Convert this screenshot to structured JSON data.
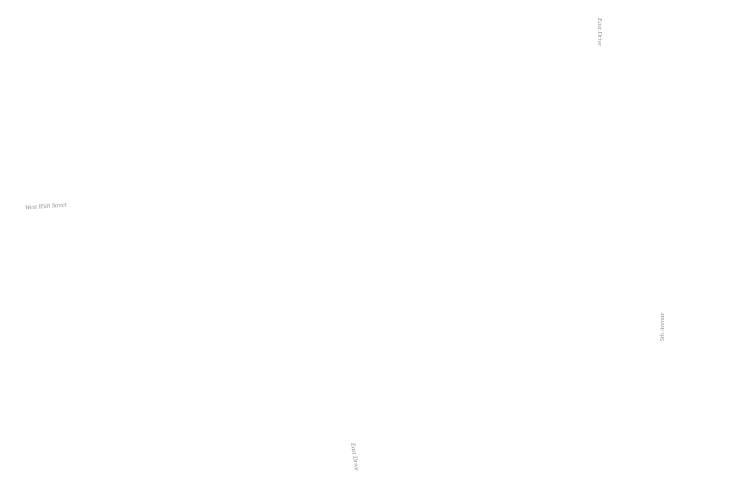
{
  "title": "Park site plan",
  "labels": {
    "west_street": "West 85th Street",
    "east_drive_top": "East Drive",
    "east_drive_bottom": "East Drive",
    "fifth_avenue": "5th Avenue"
  },
  "colors": {
    "background": "#ffffff",
    "shape_stroke": "#8f8f8f",
    "lawn_base": "#e9e9e9",
    "lawn_dot": "#d0d0d0",
    "fill_base": "#ededed",
    "fill_dot": "#c7c7c7",
    "road_line": "#c4c4c4",
    "road_dash": "#bdbdbd",
    "label_text": "#8f8f8f",
    "building": "#e5e5e5",
    "building_faint": "#f1f1f1",
    "square_stroke": "#959595"
  },
  "geometry": {
    "lawn_path": "M0,0 L557,0 L555,48 Q551,68 533,72 L503,79 L481,86 L456,97 L431,112 L402,130 L376,142 L341,152 L301,161 L261,160 L231,152 L186,150 L176,148 L161,150 L141,158 L0,158 Z",
    "lawn_bottom_edge": [
      [
        0,
        158
      ],
      [
        140,
        158
      ],
      [
        161,
        150
      ],
      [
        176,
        148
      ],
      [
        186,
        150
      ],
      [
        231,
        152
      ],
      [
        261,
        160
      ],
      [
        301,
        161
      ],
      [
        341,
        152
      ],
      [
        376,
        142
      ],
      [
        402,
        130
      ],
      [
        431,
        112
      ],
      [
        456,
        97
      ],
      [
        481,
        86
      ],
      [
        503,
        79
      ],
      [
        533,
        72
      ],
      [
        557,
        60
      ]
    ],
    "ring": {
      "cx": 103,
      "cy": 92,
      "r_outer": 61,
      "r_inner": 52
    },
    "stipple_circles": [
      {
        "cx": 529,
        "cy": 87,
        "r": 17.5
      },
      {
        "cx": 104,
        "cy": 303,
        "r": 31
      },
      {
        "cx": 212,
        "cy": 413,
        "r": 79
      },
      {
        "cx": 424,
        "cy": 411,
        "r": 33
      }
    ],
    "half_circles": [
      {
        "d": "M649,179 A28,28 0 0 0 649,235 Z"
      },
      {
        "d": "M638,380 A33,33 0 0 0 638,446 Z"
      }
    ],
    "void_squares": [
      {
        "x": 177,
        "y": 167,
        "w": 68,
        "h": 68,
        "rx": 10
      },
      {
        "x": 489,
        "y": 261,
        "w": 90,
        "h": 92,
        "rx": 12
      },
      {
        "x": 300,
        "y": 288,
        "w": 38,
        "h": 36,
        "rx": 8
      }
    ],
    "roads": {
      "west_street_lines": [
        "M0,195 C30,204 70,203 118,190 L148,181",
        "M0,211 C30,220 75,218 122,204 L152,195"
      ],
      "drive_solid_top": [
        "M590,0 L590,55",
        "M602,0 L602,55"
      ],
      "drive_dashed": [
        "M590,55 L590,338",
        "M602,55 L602,338"
      ],
      "drive_curve_bottom": [
        "M590,338 C587,415 535,465 341,499",
        "M602,338 C599,428 545,478 360,505"
      ],
      "avenue_line": "M648,0 L648,500"
    },
    "buildings": [
      "M692,2 Q688,2 688,14 L688,50 Q688,70 708,70 L728,70 L728,52 L750,52 L750,24 L736,24 L736,2 Z",
      "M687,96 L722,96 L722,108 L750,108 L750,138 L737,138 L737,160 L701,160 L701,147 L687,147 Z",
      "M687,184 L750,184 L750,214 L736,214 L736,232 L712,232 L712,246 L687,246 Z",
      "M688,269 L750,269 L750,291 L733,291 L733,312 L750,312 L750,331 L706,331 L706,318 L688,318 Z",
      "M687,353 L717,353 L717,366 L750,366 L750,397 L738,397 L738,415 L750,415 L750,431 L711,431 L711,416 L687,416 Z",
      "M687,452 L750,452 L750,500 L711,500 L711,488 L687,488 Z",
      "M588,461 L616,461 L616,456 L637,456 L637,500 L588,500 Z"
    ],
    "building_faint": "M453,472 L530,472 L530,500 L453,500 Z",
    "scatter": [
      {
        "t": "d",
        "x": 97,
        "y": 283,
        "s": 3.0,
        "f": "stip"
      },
      {
        "t": "c",
        "x": 118,
        "y": 291,
        "s": 2.5,
        "f": "none"
      },
      {
        "t": "d",
        "x": 96,
        "y": 331,
        "s": 2.6,
        "f": "none"
      },
      {
        "t": "d",
        "x": 109,
        "y": 352,
        "s": 2.2,
        "f": "stip"
      },
      {
        "t": "c",
        "x": 125,
        "y": 344,
        "s": 2.0,
        "f": "none"
      },
      {
        "t": "d",
        "x": 101,
        "y": 380,
        "s": 1.8,
        "f": "none"
      },
      {
        "t": "c",
        "x": 136,
        "y": 384,
        "s": 2.4,
        "f": "none"
      },
      {
        "t": "c",
        "x": 160,
        "y": 368,
        "s": 2.0,
        "f": "none"
      },
      {
        "t": "d",
        "x": 176,
        "y": 380,
        "s": 3.0,
        "f": "none"
      },
      {
        "t": "c",
        "x": 173,
        "y": 394,
        "s": 4.0,
        "f": "none"
      },
      {
        "t": "c",
        "x": 186,
        "y": 370,
        "s": 2.0,
        "f": "none"
      },
      {
        "t": "d",
        "x": 152,
        "y": 356,
        "s": 3.0,
        "f": "none"
      }
    ],
    "squiggles": [
      "M108,125 q6,8 -2,14 q-8,6 0,14",
      "M112,245 q-6,8 2,16",
      "M553,108 q8,6 2,14",
      "M246,92 q6,-8 14,-2",
      "M118,348 q-8,6 -2,14 q6,8 -2,12"
    ],
    "pattern": {
      "x0": 118,
      "y0": 88,
      "dx": 13.2,
      "dy": 13.2,
      "cols": 41,
      "rows": 25,
      "x_max": 648,
      "road_gap": [
        584,
        608
      ],
      "road_gap_ymax": 338,
      "exclusions": [
        {
          "cx": 103,
          "cy": 92,
          "r": 71
        },
        {
          "cx": 529,
          "cy": 87,
          "r": 27
        },
        {
          "cx": 104,
          "cy": 303,
          "r": 39
        },
        {
          "cx": 212,
          "cy": 413,
          "r": 87
        },
        {
          "cx": 424,
          "cy": 411,
          "r": 41
        },
        {
          "cx": 650,
          "cy": 207,
          "r": 34
        },
        {
          "cx": 640,
          "cy": 413,
          "r": 39
        }
      ],
      "square_margin": 9,
      "curve_excl": {
        "p0": [
          596,
          332
        ],
        "p1": [
          592,
          430
        ],
        "p2": [
          480,
          470
        ],
        "p3": [
          352,
          502
        ],
        "width": 15
      }
    }
  }
}
